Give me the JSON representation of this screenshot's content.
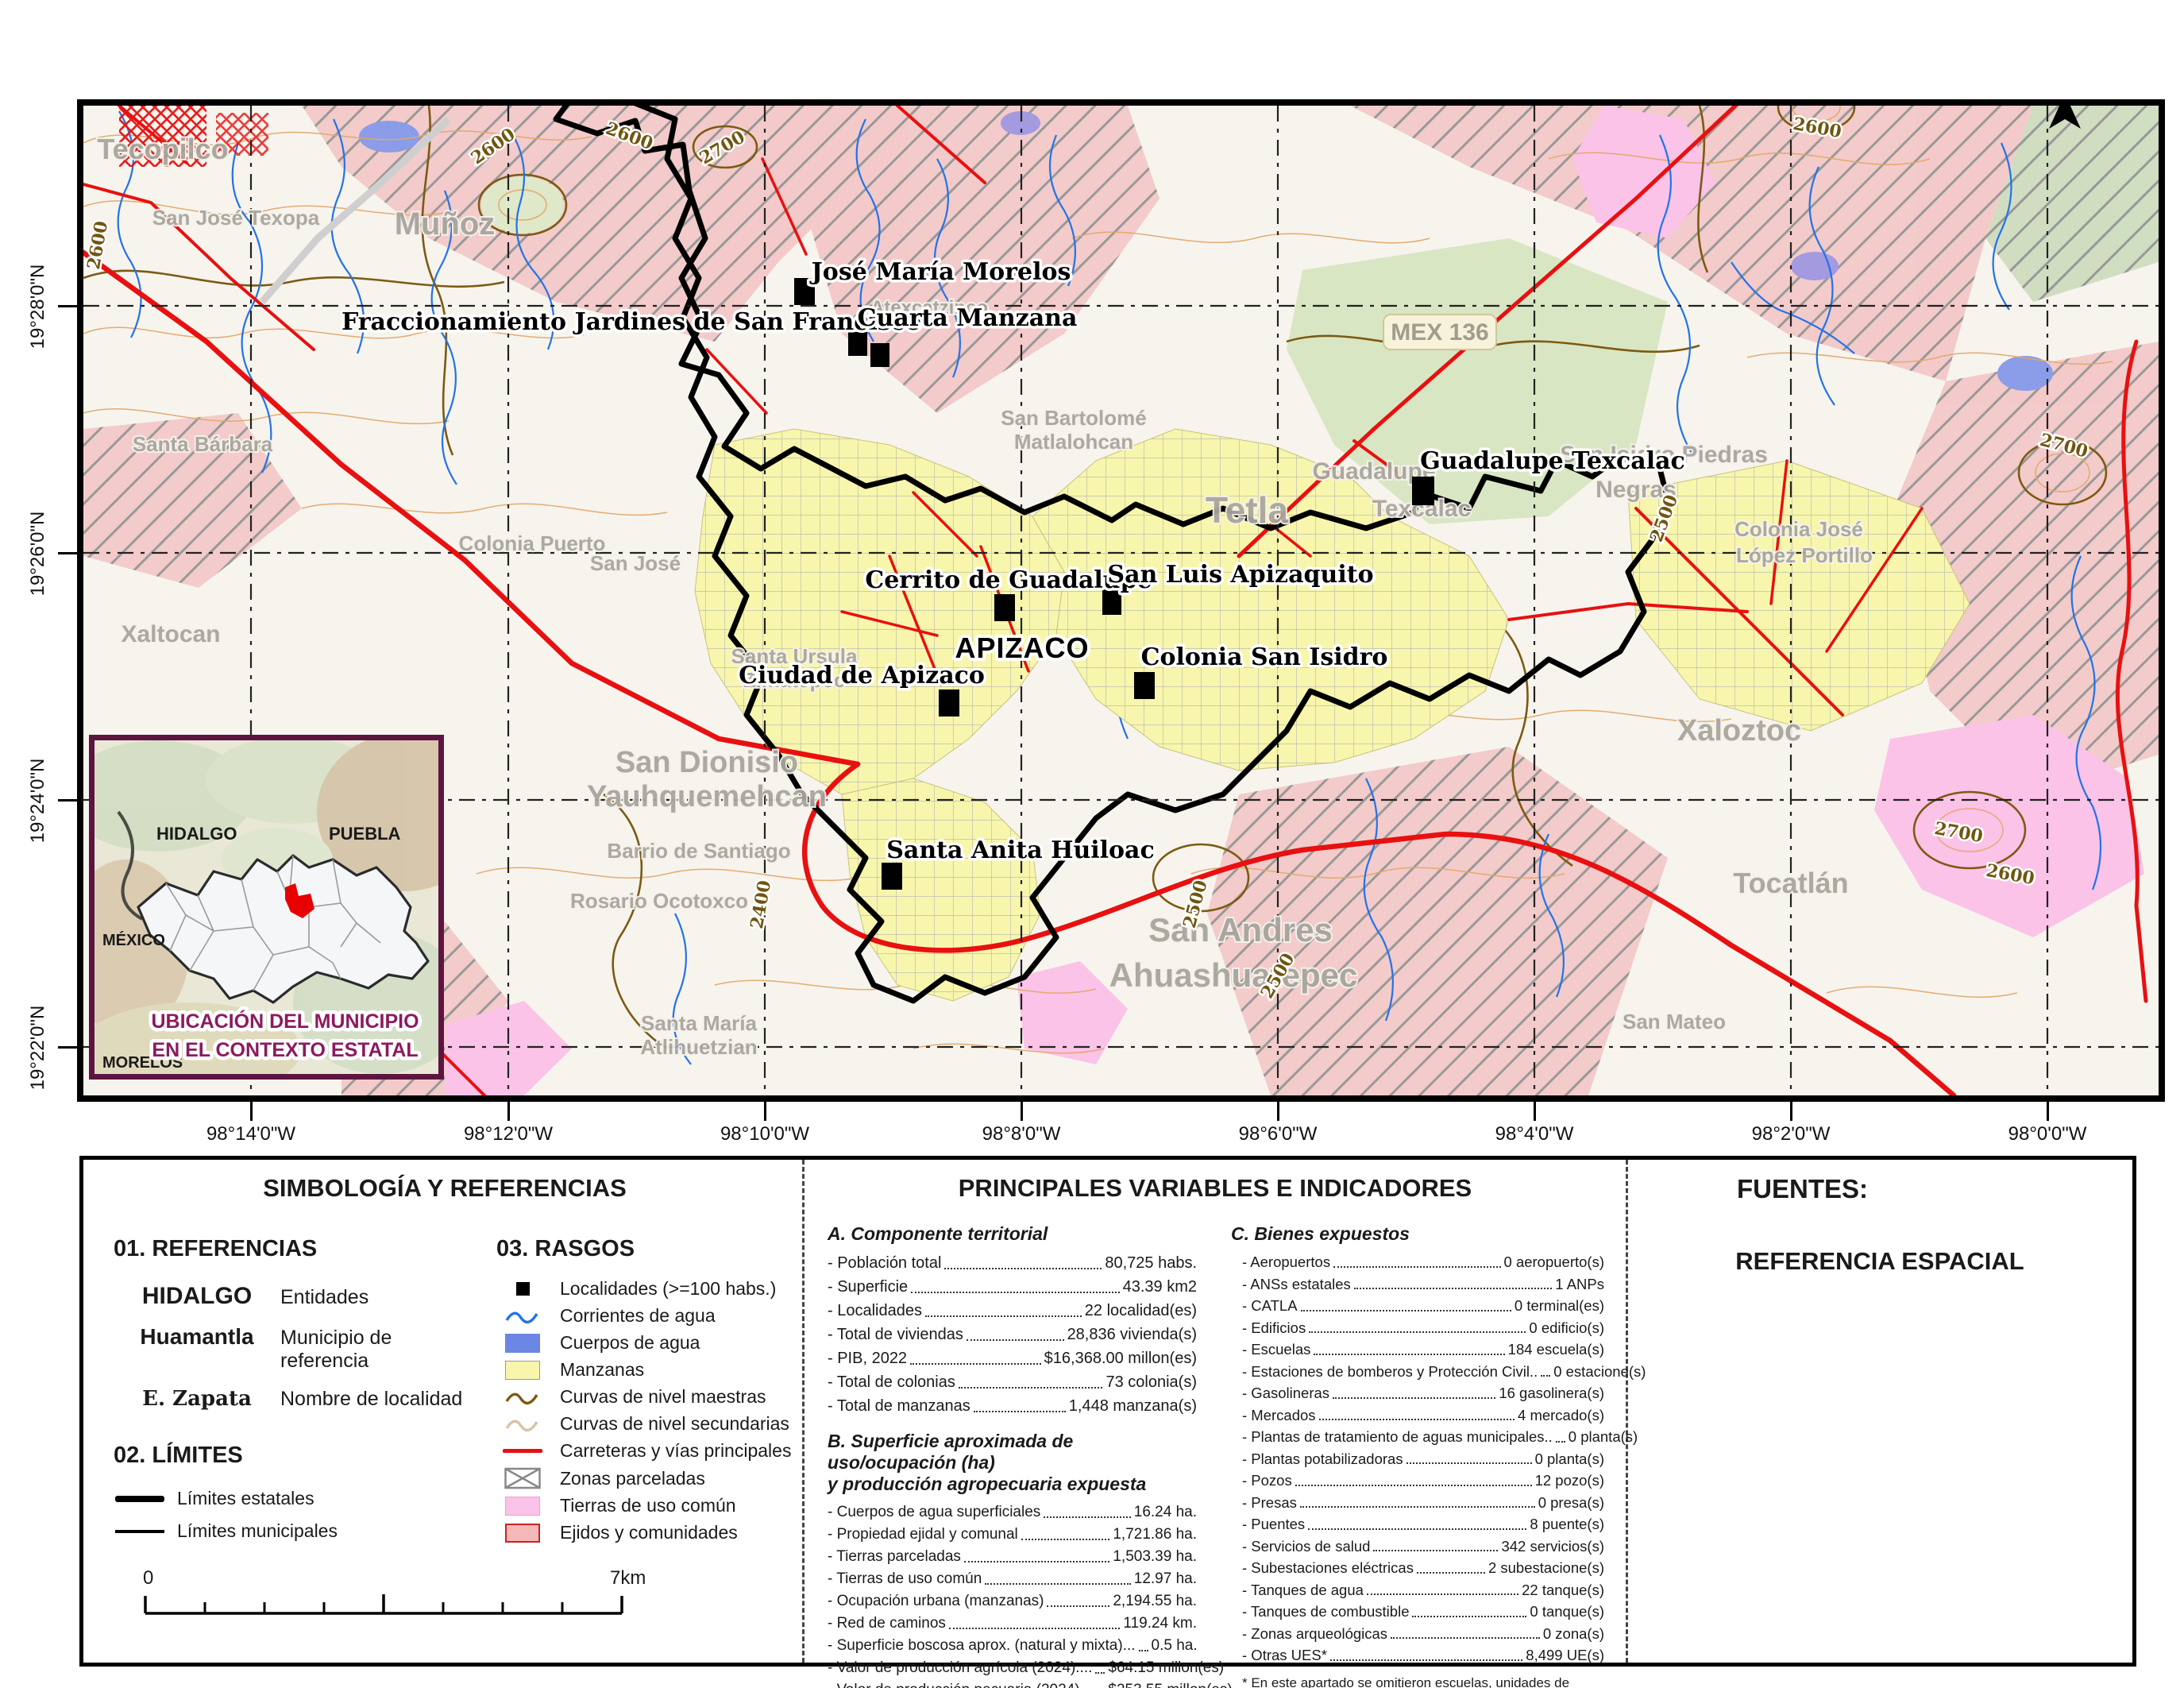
{
  "map": {
    "north": "N",
    "municipality_label": "APIZACO",
    "shield": "MEX 136",
    "lon_ticks": [
      "98°14'0\"W",
      "98°12'0\"W",
      "98°10'0\"W",
      "98°8'0\"W",
      "98°6'0\"W",
      "98°4'0\"W",
      "98°2'0\"W",
      "98°0'0\"W"
    ],
    "lat_ticks": [
      "19°28'0\"N",
      "19°26'0\"N",
      "19°24'0\"N",
      "19°22'0\"N"
    ],
    "localities": [
      {
        "name": "José María Morelos"
      },
      {
        "name": "Fraccionamiento Jardines de San Francisco"
      },
      {
        "name": "Cuarta Manzana"
      },
      {
        "name": "Cerrito de Guadalupe"
      },
      {
        "name": "San Luis Apizaquito"
      },
      {
        "name": "Ciudad de Apizaco"
      },
      {
        "name": "Colonia San Isidro"
      },
      {
        "name": "Guadalupe Texcalac"
      },
      {
        "name": "Santa Anita Huiloac"
      }
    ],
    "places": [
      "Tecopilco",
      "San José Texopa",
      "Muñoz",
      "Santa Bárbara",
      "Colonia Puerto",
      "San José",
      "Xaltocan",
      "Santa Ursula",
      "Zimatepec",
      "San Dionisio",
      "Yauhquemehcan",
      "Barrio de Santiago",
      "Rosario Ocotoxco",
      "Santa María",
      "Atlihuetzian",
      "Tetla",
      "San Bartolomé",
      "Matlalohcan",
      "Atexcatzinco",
      "Guadalupe",
      "Texcalac",
      "San Isidro Piedras",
      "Negras",
      "Colonia José",
      "López Portillo",
      "Xaloztoc",
      "San Andres",
      "Ahuashuatepec",
      "Tocatlán",
      "San Mateo"
    ],
    "contour_labels": [
      "2600",
      "2600",
      "2600",
      "2600",
      "2600",
      "2700",
      "2700",
      "2700",
      "2500",
      "2500",
      "2500",
      "2400"
    ],
    "colors": {
      "ejido": "#f3c6c6",
      "common_land": "#fbc3e8",
      "urban": "#f8f6ac",
      "water": "#6b86e3",
      "stream": "#2273e8",
      "road": "#e81010",
      "contour_master": "#7c5a12",
      "contour_secondary": "#e1a869",
      "boundary": "#000000"
    }
  },
  "inset": {
    "states": [
      "HIDALGO",
      "PUEBLA",
      "MÉXICO",
      "MORELOS"
    ],
    "caption": [
      "UBICACIÓN DEL MUNICIPIO",
      "EN EL CONTEXTO ESTATAL"
    ],
    "accent": "#8c1a5e"
  },
  "symbology": {
    "title": "SIMBOLOGÍA Y REFERENCIAS",
    "references_heading": "01. REFERENCIAS",
    "references": [
      {
        "sample": "HIDALGO",
        "label": "Entidades"
      },
      {
        "sample": "Huamantla",
        "label": "Municipio de referencia"
      },
      {
        "sample": "E. Zapata",
        "label": "Nombre de localidad"
      }
    ],
    "limits_heading": "02. LÍMITES",
    "limits": [
      {
        "label": "Límites estatales"
      },
      {
        "label": "Límites municipales"
      }
    ],
    "rasgos_heading": "03. RASGOS",
    "rasgos": [
      {
        "label": "Localidades (>=100 habs.)"
      },
      {
        "label": "Corrientes de agua"
      },
      {
        "label": "Cuerpos de agua"
      },
      {
        "label": "Manzanas"
      },
      {
        "label": "Curvas de nivel maestras"
      },
      {
        "label": "Curvas de nivel secundarias"
      },
      {
        "label": "Carreteras y vías principales"
      },
      {
        "label": "Zonas parceladas"
      },
      {
        "label": "Tierras de uso común"
      },
      {
        "label": "Ejidos y comunidades"
      }
    ],
    "scalebar": {
      "start": "0",
      "end": "7km"
    }
  },
  "indicators": {
    "title": "PRINCIPALES VARIABLES E INDICADORES",
    "a_heading": "A. Componente territorial",
    "a_rows": [
      {
        "label": "- Población total",
        "value": "80,725  habs."
      },
      {
        "label": "- Superficie",
        "value": "43.39 km2"
      },
      {
        "label": "- Localidades",
        "value": "22 localidad(es)"
      },
      {
        "label": "- Total de viviendas",
        "value": "28,836  vivienda(s)"
      },
      {
        "label": "- PIB, 2022",
        "value": "$16,368.00 millon(es)"
      },
      {
        "label": "- Total de colonias",
        "value": "73  colonia(s)"
      },
      {
        "label": "- Total de manzanas",
        "value": "1,448  manzana(s)"
      }
    ],
    "b_heading": [
      "B. Superficie aproximada de uso/ocupación (ha)",
      "y producción agropecuaria expuesta"
    ],
    "b_rows": [
      {
        "label": "- Cuerpos de agua superficiales",
        "value": "16.24 ha."
      },
      {
        "label": "- Propiedad ejidal y comunal",
        "value": "1,721.86 ha."
      },
      {
        "label": "- Tierras parceladas",
        "value": "1,503.39 ha."
      },
      {
        "label": "- Tierras de uso común",
        "value": "12.97 ha."
      },
      {
        "label": "- Ocupación urbana (manzanas)",
        "value": "2,194.55 ha."
      },
      {
        "label": "- Red de caminos",
        "value": "119.24 km."
      },
      {
        "label": "- Superficie boscosa aprox. (natural y mixta)...",
        "value": "0.5 ha."
      },
      {
        "label": "- Valor de producción agrícola (2024)....",
        "value": "$64.15 millon(es)"
      },
      {
        "label": "- Valor de producción pecuaria (2024)...",
        "value": "$253.55 millon(es)"
      },
      {
        "label": "- Cabezas de ganado",
        "value": "37,415 Cabeza(s)"
      },
      {
        "label": "- Superficie de ÁNPs federales",
        "value": "0 ha."
      }
    ],
    "c_heading": "C. Bienes expuestos",
    "c_rows": [
      {
        "label": "- Aeropuertos",
        "value": "0 aeropuerto(s)"
      },
      {
        "label": "- ANSs estatales",
        "value": "1 ANPs"
      },
      {
        "label": "- CATLA",
        "value": "0 terminal(es)"
      },
      {
        "label": "- Edificios",
        "value": "0 edificio(s)"
      },
      {
        "label": "- Escuelas",
        "value": "184 escuela(s)"
      },
      {
        "label": "- Estaciones de bomberos y Protección Civil..",
        "value": "0 estacione(s)"
      },
      {
        "label": "- Gasolineras",
        "value": "16 gasolinera(s)"
      },
      {
        "label": "- Mercados",
        "value": "4 mercado(s)"
      },
      {
        "label": "- Plantas de tratamiento de aguas municipales..",
        "value": "0 planta(s)"
      },
      {
        "label": "- Plantas potabilizadoras",
        "value": "0 planta(s)"
      },
      {
        "label": "- Pozos",
        "value": "12 pozo(s)"
      },
      {
        "label": "- Presas",
        "value": "0 presa(s)"
      },
      {
        "label": "- Puentes",
        "value": "8 puente(s)"
      },
      {
        "label": "- Servicios de salud ",
        "value": "342 servicios(s)"
      },
      {
        "label": "- Subestaciones eléctricas",
        "value": "2 subestacione(s)"
      },
      {
        "label": "- Tanques de agua",
        "value": "22 tanque(s)"
      },
      {
        "label": "- Tanques de combustible",
        "value": "0 tanque(s)"
      },
      {
        "label": "- Zonas arqueológicas",
        "value": "0 zona(s)"
      },
      {
        "label": "- Otras UES*",
        "value": "8,499 UE(s)"
      }
    ],
    "footnote": [
      "* En este apartado se omitieron escuelas, unidades de salud,",
      "gasolineras y estaciones de bomberos. al estar ya referidas."
    ]
  },
  "sources": {
    "title": "FUENTES:",
    "items": [
      "1. Continuo de Elevaciones Mexicano (CEM). INEGI, 2024.",
      "2. Marco Geoestadístico Nacional. INEGI, 2024",
      "3. Sistema para la Consulta de Información Censal. Censo de Población y Vivienda. INEGI, 2020",
      "4. PIB Turístico Municipal. INEGI, 2022",
      "5. Índices de marginación. CONEVAL, 2020",
      "6. Directorio Estadístico Nacional de Unidades Económicas. INEGI, 2025",
      "7.  Sistema de Información Agroalimentaria de Consulta (SIACON). Dirección General del Servicio de Información Agroalimentaria y Pesquera, Secretaría de Agricultura y Desarrollo Rural. 2024.",
      "8. Buscador de Datos por Área Natural Protegida. Gobierno de México, 2025. https://sig.conanp.gob.mx",
      "9. Áreas Naturales Protegidas de Tlaxcala. Secretaría del Medio Ambiente de Tlaxcala. http://sma.tlaxcala.gob.mx/areas.html"
    ]
  },
  "spatial": {
    "title": "REFERENCIA ESPACIAL",
    "items": [
      "1. Proyección de representación: Sistema Geodésico Mundial de 1984",
      "2. Proyección de las capas: Cónica Conforme de Lambert, 2008. México"
    ]
  }
}
